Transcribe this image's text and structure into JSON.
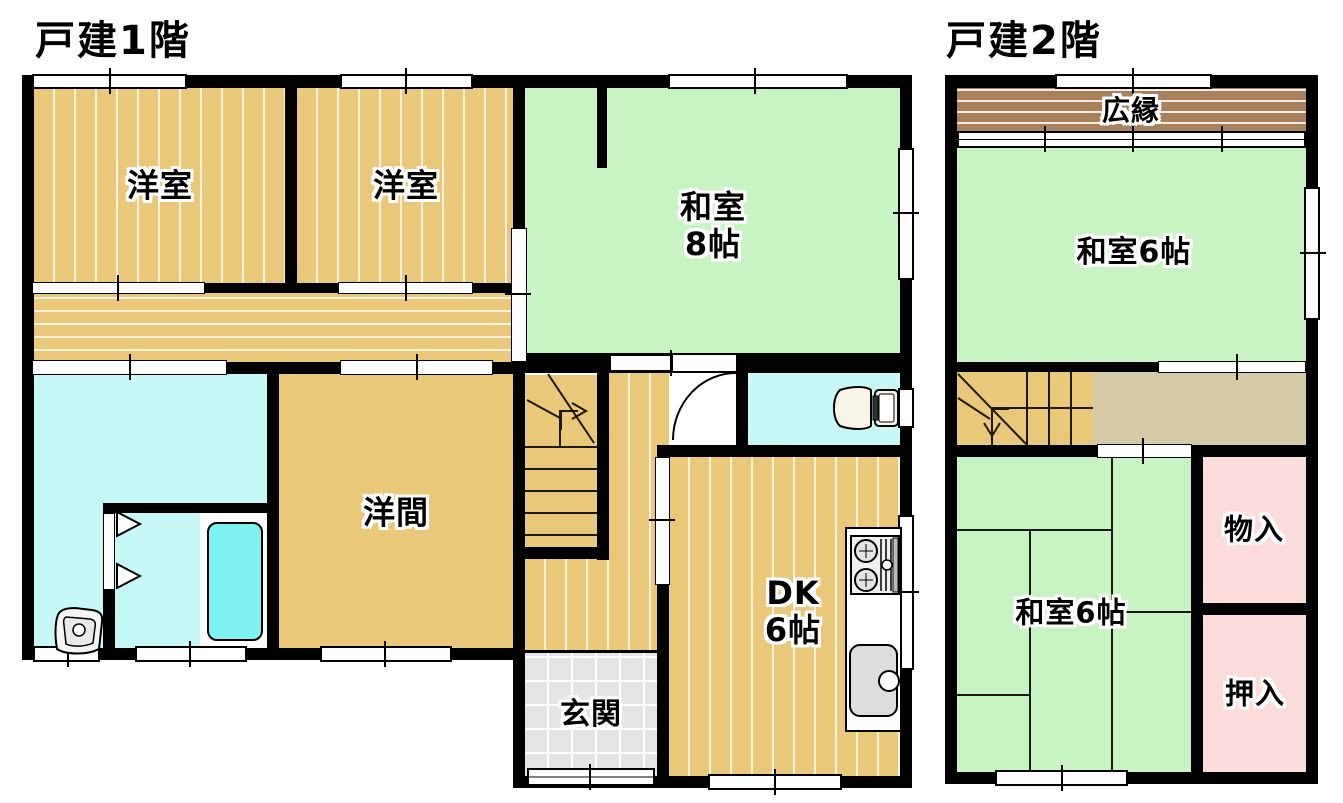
{
  "floor1": {
    "title": "戸建1階",
    "rooms": {
      "western1": "洋室",
      "western2": "洋室",
      "japanese8": "和室\n8帖",
      "western_room": "洋間",
      "dk": "DK\n6帖",
      "entrance": "玄関"
    }
  },
  "floor2": {
    "title": "戸建2階",
    "rooms": {
      "veranda": "広縁",
      "japanese6_upper": "和室6帖",
      "japanese6_lower": "和室6帖",
      "storage": "物入",
      "closet": "押入"
    }
  },
  "colors": {
    "wall": "#000000",
    "wood": "#eac87a",
    "tatami": "#c8f4c3",
    "wet": "#c5f8f6",
    "tub": "#7df2f0",
    "hiroen": "#a8815a",
    "closet": "#fcdcda",
    "hall2": "#d5caa6",
    "genkan": "#e5e5e5"
  }
}
